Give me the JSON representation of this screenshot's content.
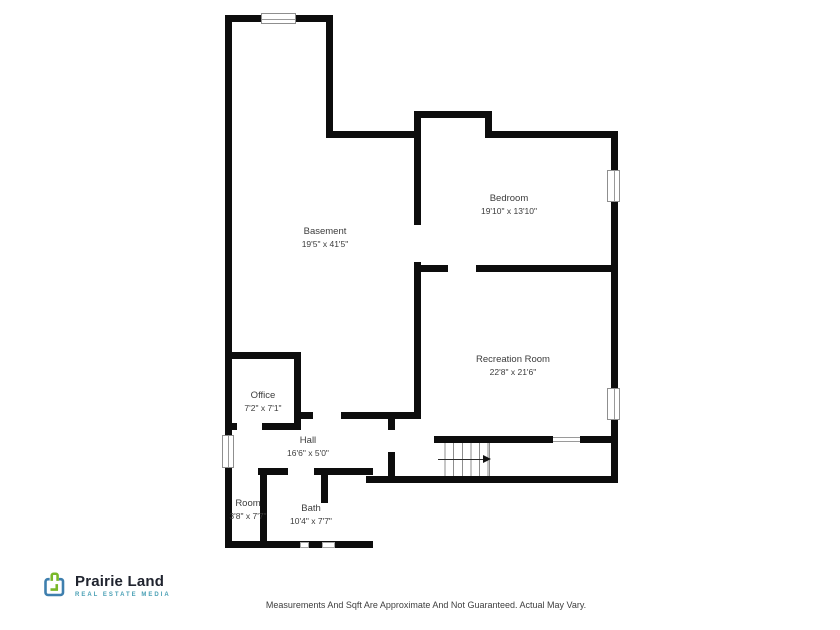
{
  "plan": {
    "wall_color": "#0d0d0d"
  },
  "rooms": [
    {
      "name": "Basement",
      "dims": "19'5\" x 41'5\""
    },
    {
      "name": "Bedroom",
      "dims": "19'10\" x 13'10\""
    },
    {
      "name": "Recreation Room",
      "dims": "22'8\" x 21'6\""
    },
    {
      "name": "Office",
      "dims": "7'2\" x 7'1\""
    },
    {
      "name": "Hall",
      "dims": "16'6\" x 5'0\""
    },
    {
      "name": "Room",
      "dims": "3'8\" x 7'7\""
    },
    {
      "name": "Bath",
      "dims": "10'4\" x 7'7\""
    }
  ],
  "branding": {
    "name": "Prairie Land",
    "tagline": "REAL ESTATE MEDIA",
    "accent_green": "#79b829",
    "accent_blue": "#3e7fae",
    "name_color": "#20242f",
    "tagline_color": "#4aa0b5"
  },
  "footer": {
    "disclaimer": "Measurements And Sqft Are Approximate And Not Guaranteed. Actual May Vary."
  }
}
